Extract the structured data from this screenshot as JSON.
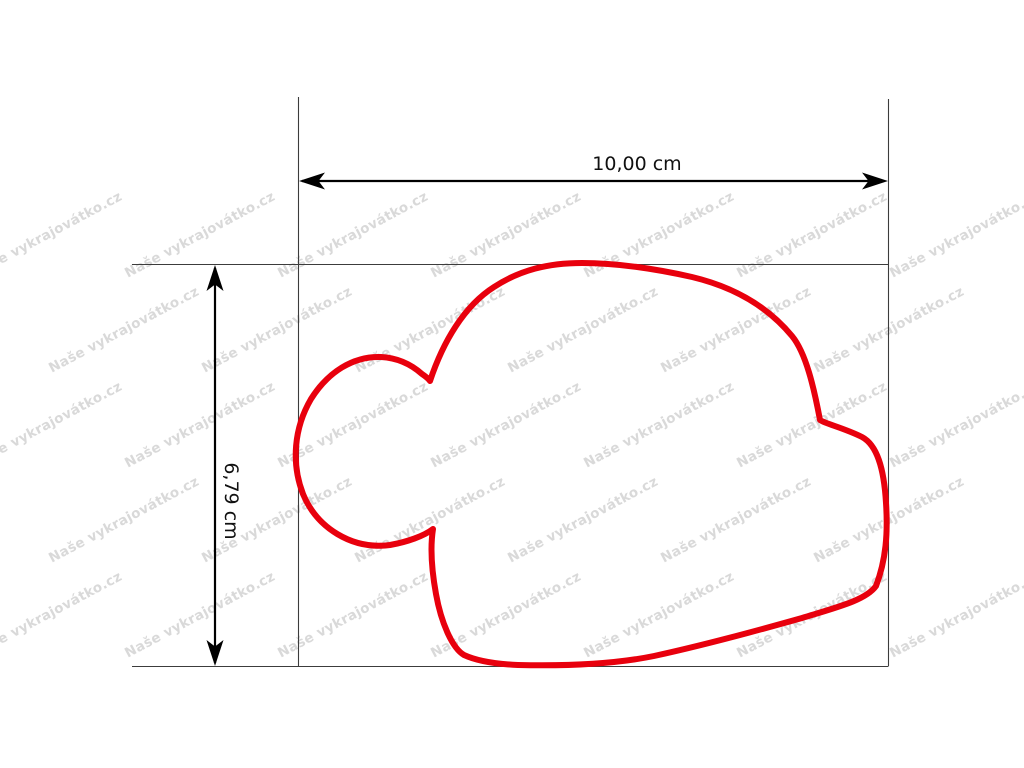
{
  "figure": {
    "width_label": "10,00 cm",
    "height_label": "6,79 cm"
  },
  "watermark": {
    "text": "Naše vykrajovátko.cz"
  },
  "colors": {
    "outline_red": "#e8000d",
    "dimension_black": "#000000",
    "boundary_gray": "#3c3c3c",
    "watermark_gray": "#d9d9d9",
    "background": "#ffffff"
  }
}
